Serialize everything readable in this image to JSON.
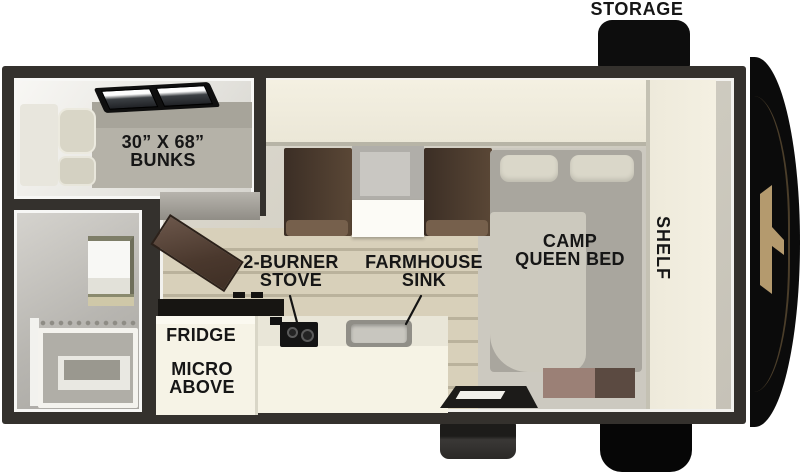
{
  "colors": {
    "wall": "#34312d",
    "shelf_cream": "#f2eede",
    "bench_brown": "#4a3a2e",
    "exterior_black": "#0d0d0d",
    "logo_tan": "#b49a6e",
    "label_text": "#161616",
    "floor_plank": "#d8d0ba"
  },
  "exterior": {
    "storage_label": "STORAGE"
  },
  "rooms": {
    "bunk_room": {
      "label": [
        "30” X 68”",
        "BUNKS"
      ]
    },
    "kitchen": {
      "stove_label": [
        "2-BURNER",
        "STOVE"
      ],
      "sink_label": [
        "FARMHOUSE",
        "SINK"
      ],
      "fridge_label": "FRIDGE",
      "micro_label": [
        "MICRO",
        "ABOVE"
      ]
    },
    "bedroom": {
      "bed_label": [
        "CAMP",
        "QUEEN BED"
      ],
      "shelf_label": "SHELF"
    }
  }
}
